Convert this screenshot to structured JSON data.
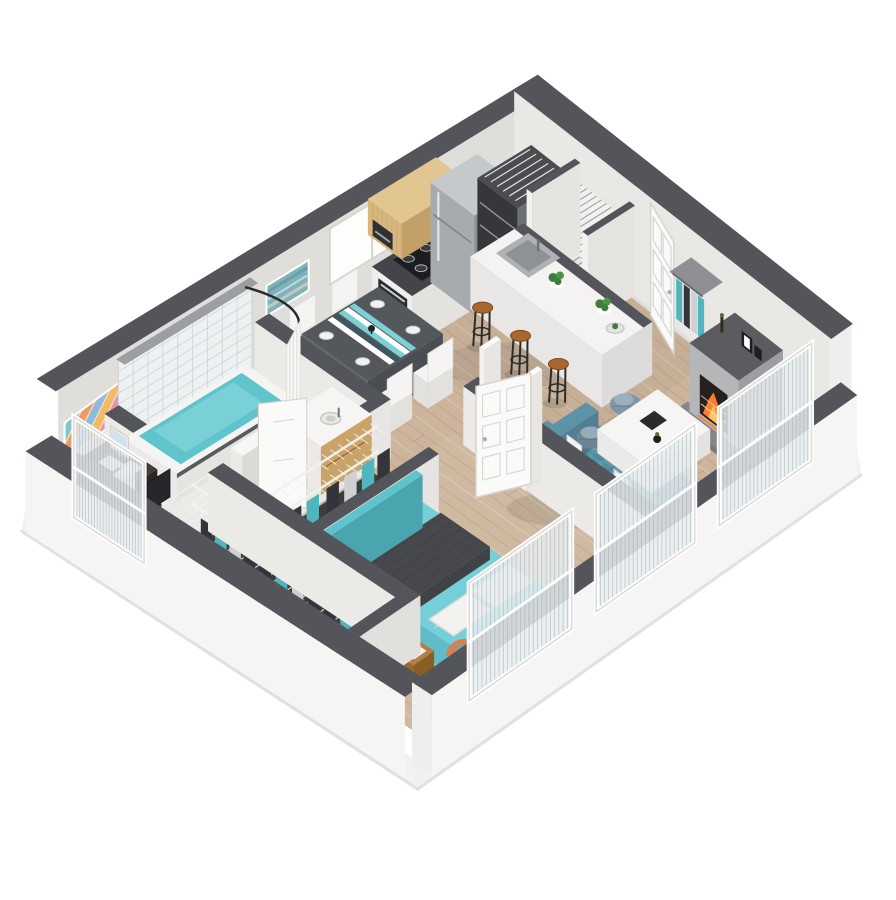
{
  "meta": {
    "type": "3d-floorplan-render",
    "style": "isometric cutaway apartment, one-bedroom unit, white background",
    "background": "#ffffff"
  },
  "rooms": {
    "kitchen": {
      "label": "Kitchen",
      "items": [
        "upper wood cabinets",
        "microwave",
        "range with black cooktop",
        "stainless refrigerator",
        "dark counter",
        "island with sink and plants",
        "3 wood bar stools",
        "window"
      ]
    },
    "laundry": {
      "label": "Laundry closet",
      "items": [
        "stacked appliances",
        "wire shelf"
      ]
    },
    "pantry": {
      "label": "Pantry",
      "items": [
        "wire shelving"
      ]
    },
    "entry": {
      "label": "Entry",
      "items": [
        "white six-panel door ajar",
        "coat rack with hanging clothes"
      ]
    },
    "living": {
      "label": "Living room",
      "items": [
        "fireplace with orange fire and picture frames",
        "teal sofa with pillows",
        "two blue-gray poufs",
        "white coffee table",
        "two glass French-door panels"
      ]
    },
    "dining": {
      "label": "Dining area",
      "items": [
        "dark table with teal striped runner",
        "4 white chairs",
        "place settings"
      ]
    },
    "bathroom": {
      "label": "Bathroom",
      "items": [
        "tiled shower wall",
        "curved rod and curtain",
        "tub with teal water",
        "toilet",
        "wood vanity with sink",
        "white door"
      ]
    },
    "linen_closet": {
      "label": "Linen closet",
      "items": [
        "wire shelves",
        "hanging clothes"
      ]
    },
    "bedroom": {
      "label": "Bedroom",
      "items": [
        "bed with teal duvet and dark gray blanket",
        "white pillows",
        "teal headboard",
        "orange accent chair",
        "wood side table",
        "glass window panel",
        "white door"
      ]
    },
    "walk_in_closet": {
      "label": "Walk-in closet",
      "items": [
        "wire shelving run",
        "hanging clothes"
      ]
    },
    "office_nook": {
      "label": "Desk nook",
      "items": [
        "dark desk",
        "monitor",
        "papers",
        "black chair",
        "low window panel",
        "abstract wall art"
      ]
    }
  },
  "palette": {
    "bg": "#ffffff",
    "wallCap": "#54555a",
    "wallInner": "#e0deda",
    "wallInnerLight": "#eae8e5",
    "wallOuter": "#f6f5f3",
    "wallOuterShade": "#efeeec",
    "slab": "#f2f1ef",
    "slabShade": "#dcdbd9",
    "floorBase": "#ccb59c",
    "plankDark": "#7d5f41",
    "plankLight": "#ffffff",
    "cabinetWood": "#d7b77e",
    "cabinetWoodDark": "#c2a068",
    "counterDark": "#43454a",
    "cooktop": "#1c1d20",
    "stainless": "#a7abae",
    "stainlessLight": "#c6c9cb",
    "stainlessDark": "#8a8f92",
    "applianceDark": "#35373b",
    "islandTop": "#f4f3f1",
    "islandSide": "#e9e7e5",
    "islandSideDark": "#dedcda",
    "stoolSeat": "#a8672e",
    "metal": "#2c2c2c",
    "plant": "#3e7d3c",
    "doorWhite": "#fafaf9",
    "doorShade": "#e7e5e2",
    "doorLine": "#d8d5d1",
    "knob": "#b0afad",
    "shelfWire": "#f1f1ee",
    "closetDark": "#3b3d41",
    "clothesTeal": "#4fb6bd",
    "clothesDark": "#33353a",
    "clothesLight": "#cfd0d2",
    "fireOrange": "#ff7c2e",
    "fireYellow": "#ffc55e",
    "fireboxDark": "#26211e",
    "mantel": "#b5b6b8",
    "mantelShade": "#9d9ea1",
    "hearth": "#85868a",
    "tableTop": "#54575c",
    "tableSide": "#646871",
    "runnerTeal": "#7fd0d4",
    "chairWhite": "#f5f4f2",
    "chairShade": "#e3e1de",
    "plate": "#f2f2f0",
    "sofaTeal": "#5e93a6",
    "sofaTealDark": "#527f92",
    "cushion": "#6ba2b4",
    "pillowWhite": "#f3f2ef",
    "pouf1": "#7e97a8",
    "pouf2": "#6d8496",
    "tile": "#eef1f2",
    "grout": "#ccd3d7",
    "tubWhite": "#f4f4f2",
    "tubRim": "#595a5e",
    "water": "#5fc4cb",
    "waterLight": "#8fdbe1",
    "porcelain": "#f7f7f5",
    "porcelainShade": "#dcdad6",
    "vanityWood": "#c9a368",
    "faucet": "#6f7377",
    "bedTeal": "#74cfd8",
    "bedTealSide": "#60bcc6",
    "blanketDark": "#47484c",
    "blanketDarker": "#3c3d41",
    "headboardTeal": "#5fc3cc",
    "accentOrange": "#ec9468",
    "accentOrangeDark": "#d97f52",
    "woodSide": "#b5803f",
    "woodSideDark": "#96682c",
    "deskDark": "#433d37",
    "deskDarker": "#332e29",
    "screenBlue": "#cfe3ee",
    "chairBlack": "#2e2f33",
    "glassFrame": "#f0efed",
    "glassLine": "#9aa0a4",
    "glassTint": "#e7edf0",
    "artTeal": "#7fb2ba",
    "artTealDark": "#5f98a1",
    "artSand": "#d9cdb8",
    "artStripes": [
      "#e88aa0",
      "#f0b65c",
      "#86b6dc",
      "#e8955c",
      "#74c4c8",
      "#6b4a3f"
    ]
  }
}
